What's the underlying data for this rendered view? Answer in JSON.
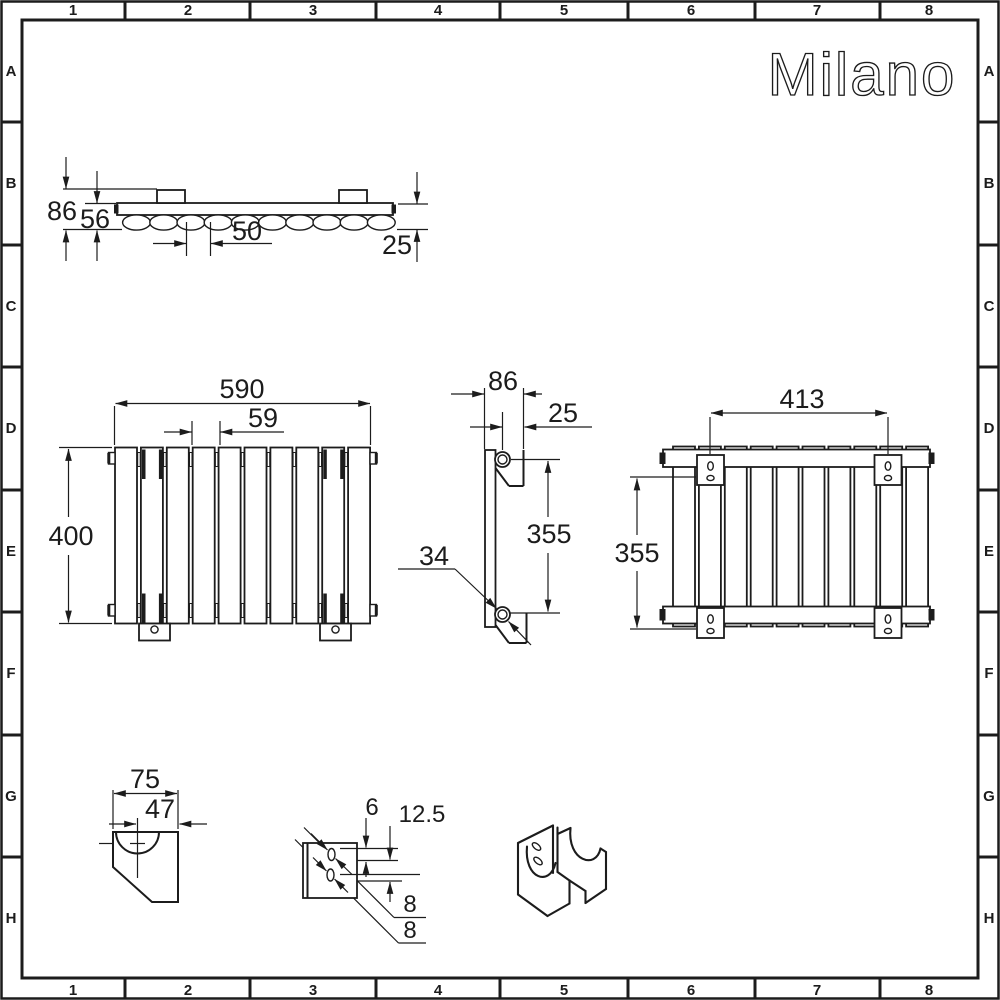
{
  "sheet": {
    "brand": "Milano"
  },
  "grid": {
    "columns": [
      "1",
      "2",
      "3",
      "4",
      "5",
      "6",
      "7",
      "8"
    ],
    "rows": [
      "A",
      "B",
      "C",
      "D",
      "E",
      "F",
      "G",
      "H"
    ]
  },
  "line_color": "#1c1c1c",
  "views": {
    "top": {
      "overall_depth": "86",
      "panel_depth": "56",
      "column_pitch": "50",
      "wall_gap": "25"
    },
    "front": {
      "width": "590",
      "panel_pitch": "59",
      "height": "400"
    },
    "side": {
      "depth": "86",
      "pipe_offset": "25",
      "bracket_span": "355",
      "pipe_diameter": "34"
    },
    "rear": {
      "bracket_spacing_horizontal": "413",
      "bracket_spacing_vertical": "355"
    },
    "bracket_face_detail": {
      "width": "75",
      "hole_offset": "47"
    },
    "bracket_profile_detail": {
      "slot_width": "6",
      "slot_pitch": "12.5",
      "slot_length_a": "8",
      "slot_length_b": "8"
    }
  }
}
